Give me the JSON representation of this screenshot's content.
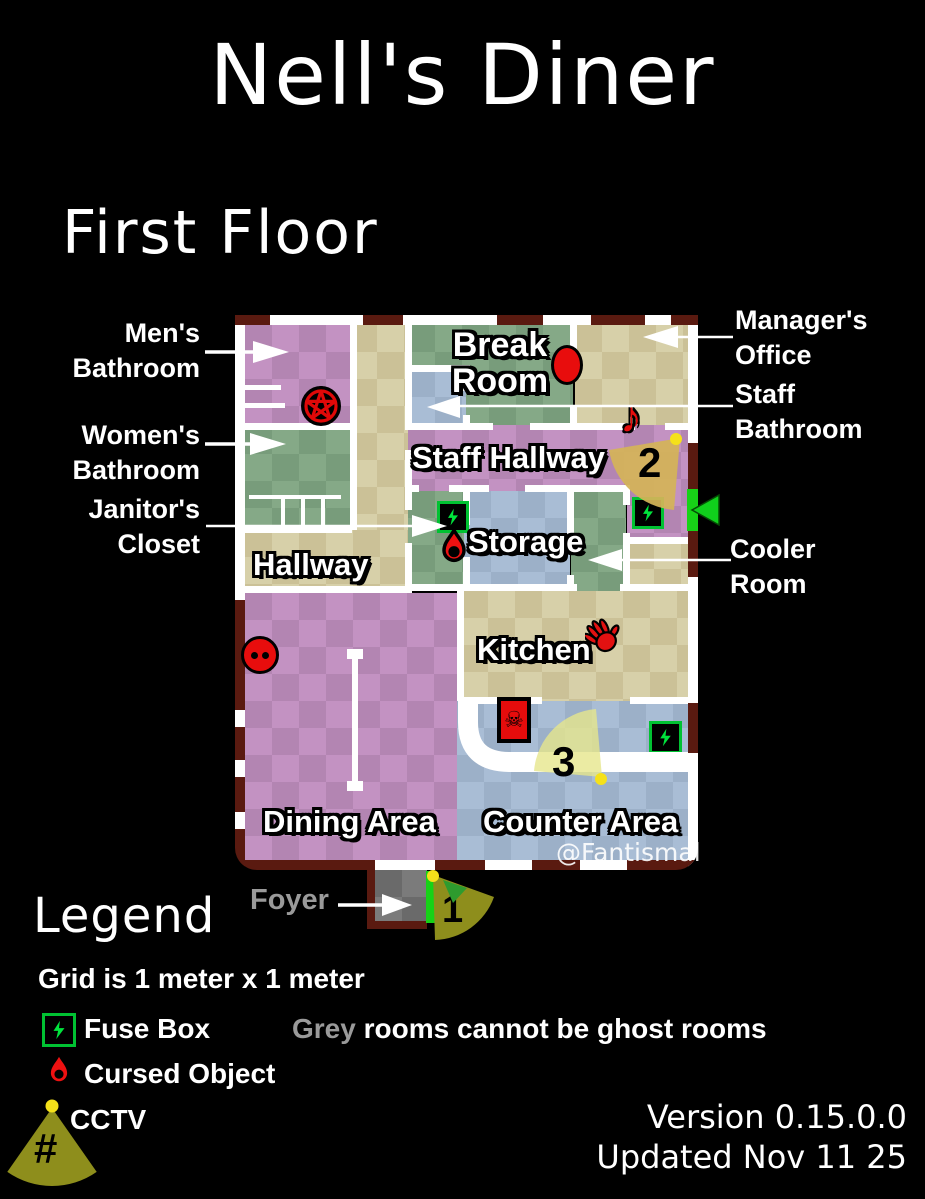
{
  "title": "Nell's Diner",
  "floor": {
    "label": "First Floor"
  },
  "watermark": "@Fantismal",
  "rooms": {
    "break_room": "Break Room",
    "staff_hallway": "Staff Hallway",
    "storage": "Storage",
    "hallway": "Hallway",
    "kitchen": "Kitchen",
    "dining_area": "Dining Area",
    "counter_area": "Counter Area",
    "foyer": "Foyer"
  },
  "callouts": {
    "mens_bathroom": "Men's Bathroom",
    "womens_bathroom": "Women's Bathroom",
    "janitors_closet": "Janitor's Closet",
    "managers_office": "Manager's Office",
    "staff_bathroom": "Staff Bathroom",
    "cooler_room": "Cooler Room",
    "foyer": "Foyer"
  },
  "cameras": {
    "cam1": "1",
    "cam2": "2",
    "cam3": "3",
    "legend_symbol": "#"
  },
  "legend": {
    "heading": "Legend",
    "grid_note": "Grid is 1 meter x 1 meter",
    "fuse_box": "Fuse Box",
    "cursed_object": "Cursed Object",
    "cctv": "CCTV",
    "grey_word": "Grey",
    "grey_note": " rooms cannot be ghost rooms"
  },
  "footer": {
    "version": "Version 0.15.0.0",
    "updated": "Updated Nov 11 25"
  },
  "icons": {
    "fuse_box": "green-lightning-bolt-box",
    "cursed_object": "red-teardrop",
    "cctv": "camera-view-cone-with-number",
    "pentagram": "red-pentagram-circle",
    "music_note": "red-music-note",
    "red_hand": "red-handprint",
    "skull_board": "red-board-black-skull",
    "red_oval": "red-oval",
    "red_circle_two_dots": "red-circle-two-dots",
    "exit_door": "green-door-bar"
  },
  "colors": {
    "background": "#000000",
    "wall_interior": "#ffffff",
    "wall_exterior": "#5a1a10",
    "exit_door_green": "#17d217",
    "room_purple": "#c392c2",
    "room_green": "#85a987",
    "room_tan": "#d7d0a9",
    "room_blue": "#a9bdd5",
    "room_grey": "#7b7b7b",
    "cctv_cone_olive": "#8e8e1c",
    "cctv_cone_gold": "#d4b458",
    "cctv_dot_yellow": "#f5e11a",
    "fuse_green": "#00e43c",
    "cursed_red": "#e81010"
  }
}
